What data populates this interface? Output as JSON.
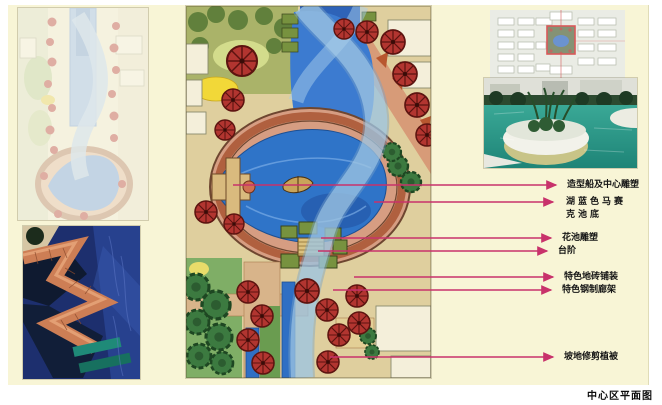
{
  "caption": "中心区平面图",
  "colors": {
    "panel_bg": "#f8f5d6",
    "leader_line": "#c8326b",
    "label_text": "#151515",
    "lake_blue": "#2f74c8",
    "path_salmon": "#b0603f",
    "tree_red": "#b23530"
  },
  "annotations": {
    "items": [
      {
        "text": "造型船及中心雕塑"
      },
      {
        "text": "湖蓝色马赛克池底"
      },
      {
        "text": "花池雕塑"
      },
      {
        "text": "台阶"
      },
      {
        "text": "特色地砖铺装"
      },
      {
        "text": "特色钢制廊架"
      },
      {
        "text": "坡地修剪植被"
      }
    ]
  }
}
